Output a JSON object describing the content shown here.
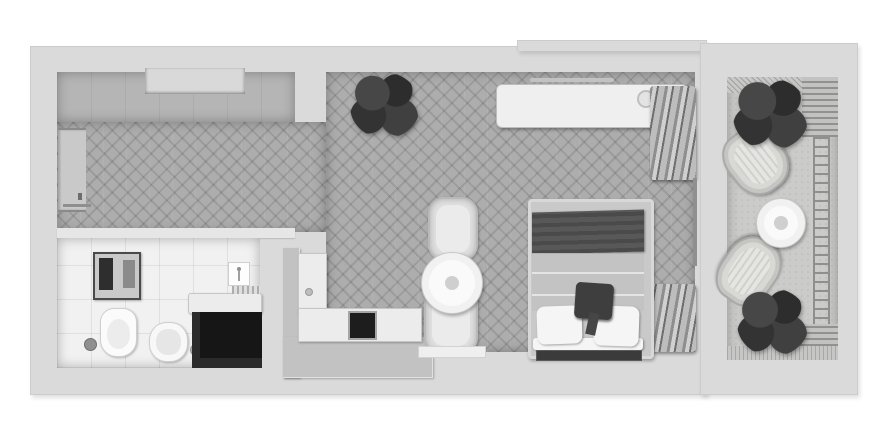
{
  "meta": {
    "content_type": "3d-top-down-floor-plan-render",
    "style": "grayscale architectural visualization, no visible text labels",
    "canvas": {
      "width": 890,
      "height": 440
    }
  },
  "palette": {
    "page_background": "#ffffff",
    "wall": "#dadada",
    "herringbone_floor": "#adadad",
    "entry_band_floor": "#b5b5b5",
    "bathroom_tile": "#f1f1f1",
    "balcony_floor": "#cbcbc9",
    "dark_furniture": "#161616",
    "blanket_dark": "#4a4a4a",
    "accent_pillow": "#3e3e3e",
    "white_furniture": "#efefef",
    "foliage": "#2d2d2d"
  },
  "rooms": [
    {
      "name": "entry-hall",
      "floor": "herringbone wood with smooth band along top wall",
      "features": [
        "entrance-door on left wall",
        "wall-niche recess in top wall",
        "open bathroom door line"
      ]
    },
    {
      "name": "bathroom",
      "floor": "white ceramic tile",
      "features": [
        "towel-rack",
        "toilet",
        "toilet-brush",
        "washbasin with accessories",
        "vanity-counter",
        "shower-panel",
        "black-cabinet"
      ]
    },
    {
      "name": "kitchen",
      "floor": "shared with hall corridor",
      "features": [
        "L-shaped white counter",
        "tall-cabinet with knob",
        "dark cooktop"
      ]
    },
    {
      "name": "living-bedroom",
      "floor": "herringbone wood",
      "features": [
        "potted-plant",
        "white sideboard with two round decor pieces",
        "wall recess above sideboard",
        "clothes-rack top-right",
        "clothes-rack bottom-right",
        "balcony glass door",
        "round dining-table with two curved chairs",
        "double bed with dark blanket, gray duvet, dark accent pillow, two white pillows",
        "dark rug at bed head",
        "doormat at bottom wall"
      ]
    },
    {
      "name": "balcony",
      "floor": "light concrete with decking strip",
      "features": [
        "pergola shade hatch at top",
        "louver panels top-right and bottom-right",
        "railing along right edge",
        "two dark leafy plants",
        "two rattan lounge chairs",
        "round white coffee table"
      ]
    }
  ]
}
